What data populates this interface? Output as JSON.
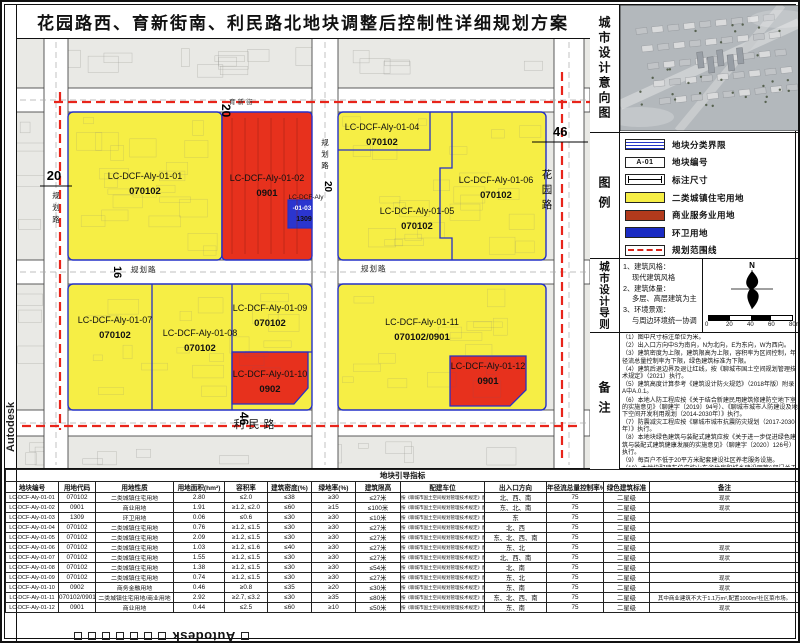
{
  "title": "花园路西、育新街南、利民路北地块调整后控制性详细规划方案",
  "watermark": {
    "text": "Autodesk"
  },
  "intent": {
    "label": "城市设计意向图"
  },
  "legend": {
    "label": "图例",
    "items": [
      {
        "name": "plot-boundary",
        "type": "boundary",
        "label": "地块分类界限"
      },
      {
        "name": "plot-code",
        "type": "code",
        "text": "A-01",
        "label": "地块编号"
      },
      {
        "name": "dimension",
        "type": "dim",
        "label": "标注尺寸"
      },
      {
        "name": "residential",
        "type": "fill",
        "color": "#f6ee45",
        "label": "二类城镇住宅用地"
      },
      {
        "name": "commercial",
        "type": "fill",
        "color": "#b23a1c",
        "label": "商业服务业用地"
      },
      {
        "name": "sanitation",
        "type": "fill",
        "color": "#1a2bc4",
        "label": "环卫用地"
      },
      {
        "name": "planning-scope",
        "type": "dash",
        "color": "#d92318",
        "label": "规划范围线"
      }
    ]
  },
  "guidelines": {
    "label": "城市设计导则",
    "compass": "N",
    "scale_ticks": [
      "0",
      "20",
      "40",
      "60",
      "80m"
    ],
    "items": [
      {
        "no": "1、",
        "head": "建筑风格：",
        "body": "现代建筑风格"
      },
      {
        "no": "2、",
        "head": "建筑体量：",
        "body": "多层、高层建筑为主"
      },
      {
        "no": "3、",
        "head": "环境景观：",
        "body": "与周边环境统一协调"
      }
    ]
  },
  "notes": {
    "label": "备注",
    "items": [
      "（1）图中尺寸标注单位为米。",
      "（2）出入口方向中S为南向，N为北向，E为东向，W为西向。",
      "（3）建筑密度为上限，建筑限高为上限，容积率为区间控制，年径流总量控制率为下限，绿色建筑标准为下限。",
      "（4）建筑后退边界及退让红线，按《聊城市国土空间规划管理技术规定》（2021）执行。",
      "（5）建筑高度计算参考《建筑设计防火规范》（2018年版）附录A中A.0.1。",
      "（6）本地人防工程应按《关于结合新建民用建筑修建防空地下室的实施意见》（聊建字〔2019〕94号）、《聊城市城市人防建设及地下空间开发利用规划（2014-2030年）》执行。",
      "（7）防震减灾工程应按《聊城市城市抗震防灾规划（2017-2030年）》执行。",
      "（8）本地块绿色建筑与装配式建筑应按《关于进一步促进绿色建筑与装配式建筑健康发展的实施意见》（聊建字〔2020〕126号）执行。",
      "（9）每百户不低于20平方米配套建设社区养老服务设施。",
      "（10）本地块配建车位应按山东省住房和城乡建设厅等6部门关于推动城市停车设施发展的实施意见（鲁建发〔2021〕6号）执行，原则上不低于1:1.1，如建设高标准住宅项目，应按有关规定执行。"
    ]
  },
  "map": {
    "plots": [
      {
        "id": "LC-DCF-Aly-01-01",
        "code": "070102"
      },
      {
        "id": "LC-DCF-Aly-01-02",
        "code": "0901"
      },
      {
        "id": "LC-DCF-Aly-01-03",
        "code": "1309"
      },
      {
        "id": "LC-DCF-Aly-01-04",
        "code": "070102"
      },
      {
        "id": "LC-DCF-Aly-01-05",
        "code": "070102"
      },
      {
        "id": "LC-DCF-Aly-01-06",
        "code": "070102"
      },
      {
        "id": "LC-DCF-Aly-01-07",
        "code": "070102"
      },
      {
        "id": "LC-DCF-Aly-01-08",
        "code": "070102"
      },
      {
        "id": "LC-DCF-Aly-01-09",
        "code": "070102"
      },
      {
        "id": "LC-DCF-Aly-01-10",
        "code": "0902"
      },
      {
        "id": "LC-DCF-Aly-01-11",
        "code": "070102/0901"
      },
      {
        "id": "LC-DCF-Aly-01-12",
        "code": "0901"
      }
    ],
    "roads": [
      "花园路",
      "利民路",
      "育新街",
      "规划路",
      "规划路",
      "规划路",
      "规划路"
    ],
    "dimensions": [
      "20",
      "20",
      "16",
      "20",
      "46",
      "46"
    ]
  },
  "table": {
    "title": "地块引导指标",
    "headers": [
      "地块编号",
      "用地代码",
      "用地性质",
      "用地面积(hm²)",
      "容积率",
      "建筑密度(%)",
      "绿地率(%)",
      "建筑限高",
      "配建车位",
      "出入口方向",
      "年径流总量控制率%",
      "绿色建筑标准",
      "备注"
    ],
    "parking": "按《聊城市国土空间规划管理技术规定》配建",
    "rows": [
      [
        "LC-DCF-Aly-01-01",
        "070102",
        "二类城镇住宅用地",
        "2.80",
        "≤2.0",
        "≤38",
        "≥30",
        "≤27米",
        "北、西、南",
        "75",
        "二星级",
        "现状"
      ],
      [
        "LC-DCF-Aly-01-02",
        "0901",
        "商业用地",
        "1.91",
        "≥1.2, ≤2.0",
        "≤60",
        "≥15",
        "≤100米",
        "东、北、南",
        "75",
        "二星级",
        "现状"
      ],
      [
        "LC-DCF-Aly-01-03",
        "1309",
        "环卫用地",
        "0.06",
        "≤0.6",
        "≤30",
        "≥30",
        "≤10米",
        "东",
        "75",
        "二星级",
        ""
      ],
      [
        "LC-DCF-Aly-01-04",
        "070102",
        "二类城镇住宅用地",
        "0.76",
        "≥1.2, ≤1.5",
        "≤30",
        "≥30",
        "≤27米",
        "北、西",
        "75",
        "二星级",
        ""
      ],
      [
        "LC-DCF-Aly-01-05",
        "070102",
        "二类城镇住宅用地",
        "2.09",
        "≥1.2, ≤1.5",
        "≤30",
        "≥30",
        "≤27米",
        "东、北、西、南",
        "75",
        "二星级",
        ""
      ],
      [
        "LC-DCF-Aly-01-06",
        "070102",
        "二类城镇住宅用地",
        "1.03",
        "≥1.2, ≤1.6",
        "≤40",
        "≥30",
        "≤27米",
        "东、北",
        "75",
        "二星级",
        "现状"
      ],
      [
        "LC-DCF-Aly-01-07",
        "070102",
        "二类城镇住宅用地",
        "1.55",
        "≥1.2, ≤1.5",
        "≤30",
        "≥30",
        "≤27米",
        "北、西、南",
        "75",
        "二星级",
        "现状"
      ],
      [
        "LC-DCF-Aly-01-08",
        "070102",
        "二类城镇住宅用地",
        "1.38",
        "≥1.2, ≤1.5",
        "≤30",
        "≥30",
        "≤54米",
        "北、南",
        "75",
        "二星级",
        ""
      ],
      [
        "LC-DCF-Aly-01-09",
        "070102",
        "二类城镇住宅用地",
        "0.74",
        "≥1.2, ≤1.5",
        "≤30",
        "≥30",
        "≤27米",
        "东、北",
        "75",
        "二星级",
        "现状"
      ],
      [
        "LC-DCF-Aly-01-10",
        "0902",
        "商务金融用地",
        "0.46",
        "≥0.8",
        "≤35",
        "≥20",
        "≤30米",
        "东、南",
        "75",
        "二星级",
        "现状"
      ],
      [
        "LC-DCF-Aly-01-11",
        "070102/0901",
        "二类城镇住宅用地/商业用地",
        "2.92",
        "≥2.7, ≤3.2",
        "≤30",
        "≥35",
        "≤80米",
        "东、北、西、南",
        "75",
        "二星级",
        "其中商业建筑不大于1.1万m²,配置1000m²社区菜市场。"
      ],
      [
        "LC-DCF-Aly-01-12",
        "0901",
        "商业用地",
        "0.44",
        "≤2.5",
        "≤60",
        "≥10",
        "≤50米",
        "东、南",
        "75",
        "二星级",
        "现状"
      ]
    ]
  }
}
